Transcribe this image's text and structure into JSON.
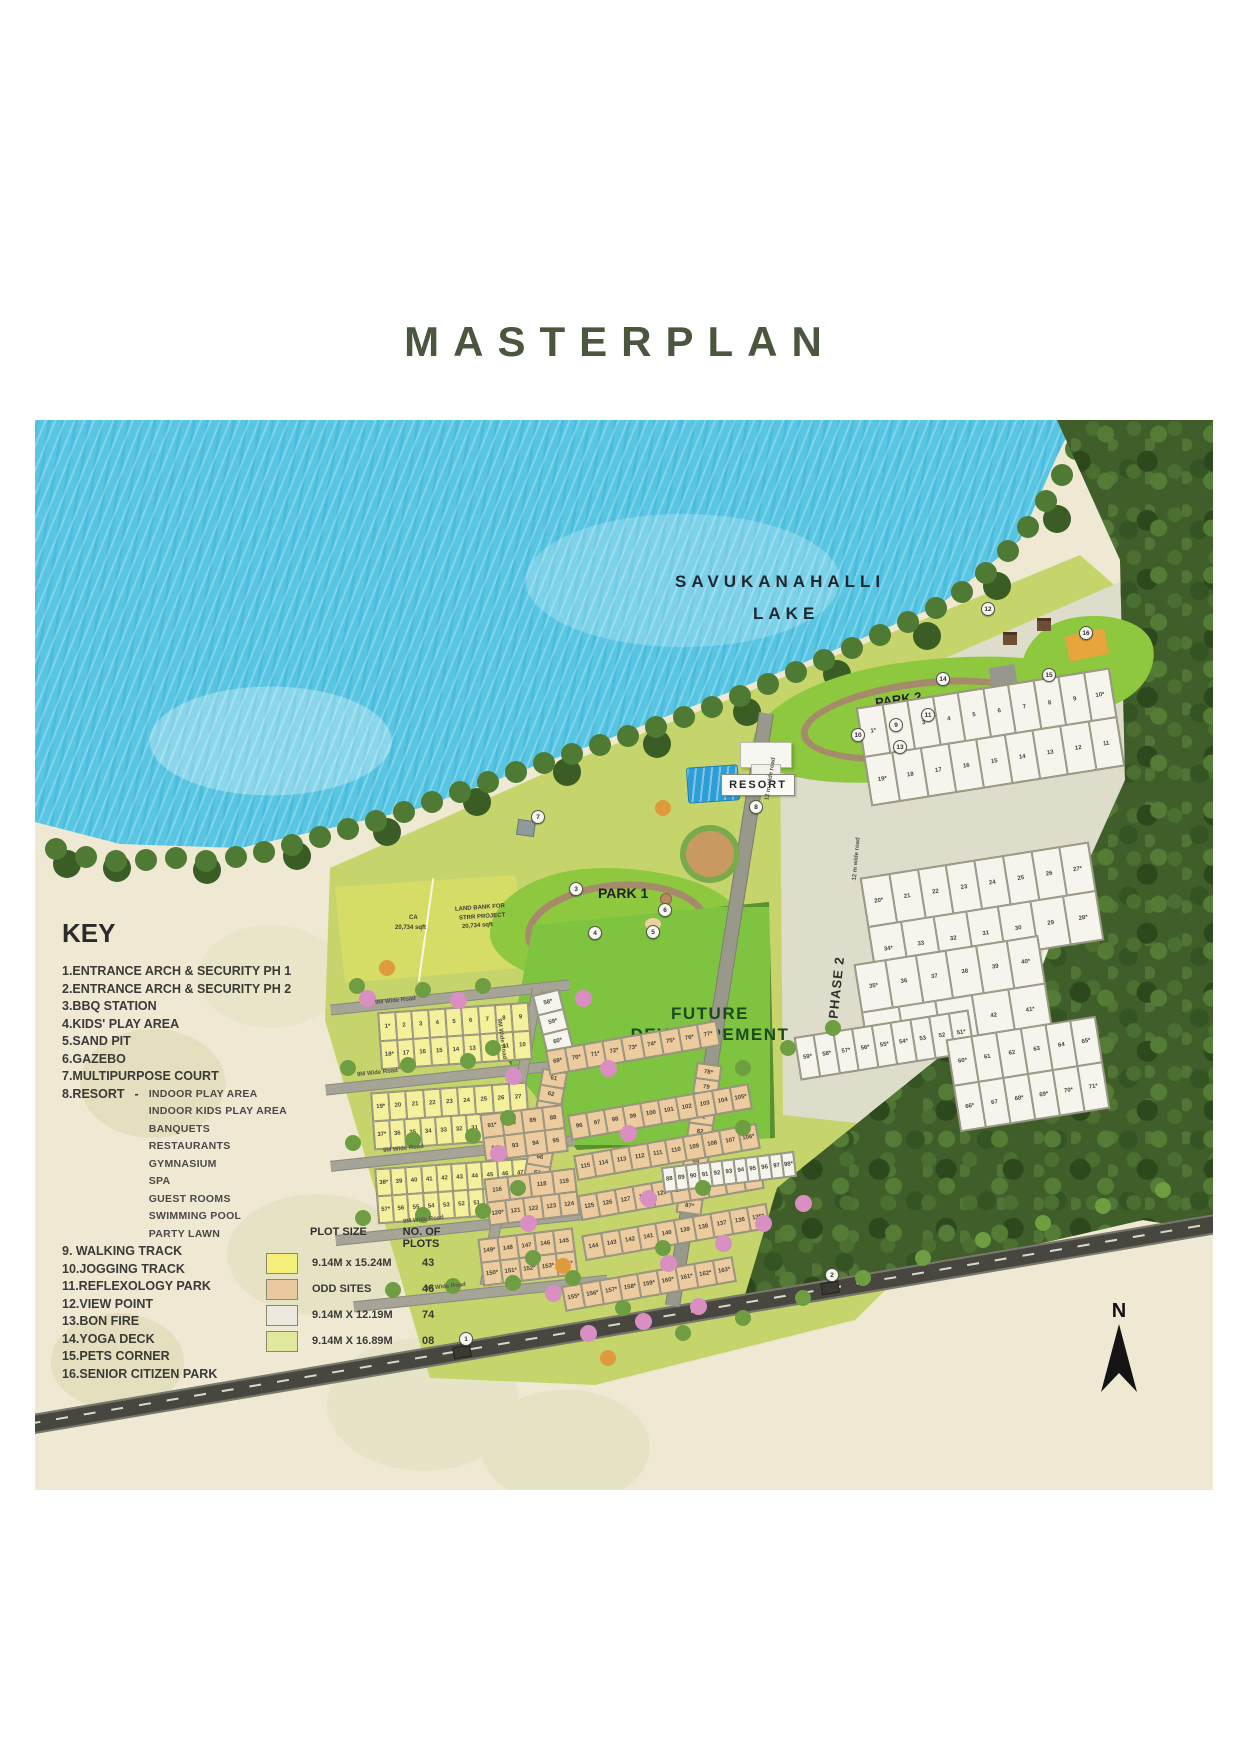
{
  "title": "MASTERPLAN",
  "map": {
    "labels": {
      "lake": [
        "SAVUKANAHALLI",
        "LAKE"
      ],
      "forest": "FOREST",
      "phase2": "PHASE 2",
      "park1": "PARK 1",
      "park2": "PARK 2",
      "resort": "RESORT",
      "future": [
        "FUTURE",
        "DEVELOPEMENT"
      ],
      "landbank1": [
        "LAND BANK FOR",
        "STRR PROJECT",
        "20,734 sqft"
      ],
      "ca1": [
        "CA",
        "20,734 sqft"
      ],
      "landbank2": [
        "LAND BANK FOR STRR PROJECT",
        "20,396 sqft"
      ],
      "ca2": [
        "CA",
        "20,692 sqft"
      ],
      "north": "N"
    },
    "road_labels": [
      {
        "t": "9M Wide Road",
        "x": 340,
        "y": 578,
        "r": -6
      },
      {
        "t": "9M Wide Road",
        "x": 322,
        "y": 650,
        "r": -6
      },
      {
        "t": "9M Wide Road",
        "x": 348,
        "y": 726,
        "r": -6
      },
      {
        "t": "9M Wide Road",
        "x": 368,
        "y": 797,
        "r": -6
      },
      {
        "t": "9M Wide Road",
        "x": 390,
        "y": 864,
        "r": -6
      },
      {
        "t": "9M Wide Road",
        "x": 446,
        "y": 616,
        "r": 82
      },
      {
        "t": "12 m wide road",
        "x": 800,
        "y": 436,
        "r": -85
      },
      {
        "t": "12 m wide road",
        "x": 714,
        "y": 356,
        "r": -81
      }
    ],
    "markers": [
      {
        "n": "1",
        "x": 424,
        "y": 912
      },
      {
        "n": "2",
        "x": 790,
        "y": 848
      },
      {
        "n": "3",
        "x": 534,
        "y": 462
      },
      {
        "n": "4",
        "x": 553,
        "y": 506
      },
      {
        "n": "5",
        "x": 611,
        "y": 505
      },
      {
        "n": "6",
        "x": 623,
        "y": 483
      },
      {
        "n": "7",
        "x": 496,
        "y": 390
      },
      {
        "n": "8",
        "x": 714,
        "y": 380
      },
      {
        "n": "9",
        "x": 854,
        "y": 298
      },
      {
        "n": "10",
        "x": 816,
        "y": 308
      },
      {
        "n": "11",
        "x": 886,
        "y": 288
      },
      {
        "n": "12",
        "x": 946,
        "y": 182
      },
      {
        "n": "13",
        "x": 858,
        "y": 320
      },
      {
        "n": "14",
        "x": 901,
        "y": 252
      },
      {
        "n": "15",
        "x": 1007,
        "y": 248
      },
      {
        "n": "16",
        "x": 1044,
        "y": 206
      }
    ],
    "plot_blocks": [
      {
        "x": 345,
        "y": 588,
        "w": 150,
        "h": 56,
        "r": -4,
        "c": "yellow",
        "rows": [
          [
            "1*",
            "2",
            "3",
            "4",
            "5",
            "6",
            "7",
            "8",
            "9"
          ],
          [
            "18*",
            "17",
            "16",
            "15",
            "14",
            "13",
            "12",
            "11",
            "10"
          ]
        ]
      },
      {
        "x": 505,
        "y": 572,
        "w": 26,
        "h": 60,
        "r": -14,
        "c": "white",
        "rows": [
          [
            "58*"
          ],
          [
            "59*"
          ],
          [
            "60*"
          ]
        ]
      },
      {
        "x": 338,
        "y": 668,
        "w": 155,
        "h": 56,
        "r": -4,
        "c": "yellow",
        "rows": [
          [
            "19*",
            "20",
            "21",
            "22",
            "23",
            "24",
            "25",
            "26",
            "27"
          ],
          [
            "37*",
            "36",
            "35",
            "34",
            "33",
            "32",
            "31",
            "30",
            "29",
            "28"
          ]
        ]
      },
      {
        "x": 342,
        "y": 744,
        "w": 152,
        "h": 54,
        "r": -4,
        "c": "yellow",
        "rows": [
          [
            "38*",
            "39",
            "40",
            "41",
            "42",
            "43",
            "44",
            "45",
            "46",
            "47"
          ],
          [
            "57*",
            "56",
            "55",
            "54",
            "53",
            "52",
            "51",
            "50",
            "49",
            "48"
          ]
        ]
      },
      {
        "x": 497,
        "y": 650,
        "w": 24,
        "h": 128,
        "r": 10,
        "c": "tan",
        "rows": [
          [
            "61"
          ],
          [
            "62"
          ],
          [
            "63"
          ],
          [
            "64"
          ],
          [
            "65"
          ],
          [
            "66"
          ],
          [
            "67"
          ],
          [
            "68"
          ]
        ]
      },
      {
        "x": 512,
        "y": 616,
        "w": 172,
        "h": 24,
        "r": -10,
        "c": "tan",
        "rows": [
          [
            "69*",
            "70*",
            "71*",
            "72*",
            "73*",
            "74*",
            "75*",
            "76*",
            "77*"
          ]
        ]
      },
      {
        "x": 652,
        "y": 644,
        "w": 24,
        "h": 150,
        "r": 8,
        "c": "tan",
        "rows": [
          [
            "78*"
          ],
          [
            "79"
          ],
          [
            "80"
          ],
          [
            "81"
          ],
          [
            "82"
          ],
          [
            "83"
          ],
          [
            "84"
          ],
          [
            "85"
          ],
          [
            "86"
          ],
          [
            "87*"
          ]
        ]
      },
      {
        "x": 448,
        "y": 690,
        "w": 82,
        "h": 46,
        "r": -7,
        "c": "tan",
        "rows": [
          [
            "91*",
            "90",
            "89",
            "88"
          ],
          [
            "92",
            "93",
            "94",
            "95"
          ]
        ]
      },
      {
        "x": 534,
        "y": 680,
        "w": 182,
        "h": 24,
        "r": -10,
        "c": "tan",
        "rows": [
          [
            "96",
            "97",
            "98",
            "99",
            "100",
            "101",
            "102",
            "103",
            "104",
            "105*"
          ]
        ]
      },
      {
        "x": 540,
        "y": 720,
        "w": 184,
        "h": 24,
        "r": -10,
        "c": "tan",
        "rows": [
          [
            "115",
            "114",
            "113",
            "112",
            "111",
            "110",
            "109",
            "108",
            "107",
            "106*"
          ]
        ]
      },
      {
        "x": 452,
        "y": 754,
        "w": 90,
        "h": 46,
        "r": -7,
        "c": "tan",
        "rows": [
          [
            "116",
            "117",
            "118",
            "119"
          ],
          [
            "120*",
            "121",
            "122",
            "123",
            "124"
          ]
        ]
      },
      {
        "x": 544,
        "y": 760,
        "w": 184,
        "h": 24,
        "r": -10,
        "c": "tan",
        "rows": [
          [
            "125",
            "126",
            "127",
            "128",
            "129",
            "130",
            "131",
            "132",
            "133",
            "134*"
          ]
        ]
      },
      {
        "x": 446,
        "y": 814,
        "w": 94,
        "h": 46,
        "r": -7,
        "c": "tan",
        "rows": [
          [
            "149*",
            "148",
            "147",
            "146",
            "145"
          ],
          [
            "150*",
            "151*",
            "152*",
            "153*",
            "154*"
          ]
        ]
      },
      {
        "x": 548,
        "y": 800,
        "w": 186,
        "h": 24,
        "r": -10,
        "c": "tan",
        "rows": [
          [
            "144",
            "143",
            "142",
            "141",
            "140",
            "139",
            "138",
            "137",
            "136",
            "135*"
          ]
        ]
      },
      {
        "x": 528,
        "y": 852,
        "w": 172,
        "h": 24,
        "r": -10,
        "c": "tan",
        "rows": [
          [
            "155*",
            "156*",
            "157*",
            "158*",
            "159*",
            "160*",
            "161*",
            "162*",
            "163*"
          ]
        ]
      },
      {
        "x": 828,
        "y": 268,
        "w": 255,
        "h": 98,
        "r": -9,
        "c": "white",
        "rows": [
          [
            "1*",
            "2",
            "3",
            "4",
            "5",
            "6",
            "7",
            "8",
            "9",
            "10*"
          ],
          [
            "19*",
            "18",
            "17",
            "16",
            "15",
            "14",
            "13",
            "12",
            "11"
          ]
        ]
      },
      {
        "x": 832,
        "y": 440,
        "w": 230,
        "h": 98,
        "r": -9,
        "c": "white",
        "rows": [
          [
            "20*",
            "21",
            "22",
            "23",
            "24",
            "25",
            "26",
            "27*"
          ],
          [
            "34*",
            "33",
            "32",
            "31",
            "30",
            "29",
            "28*"
          ]
        ]
      },
      {
        "x": 826,
        "y": 530,
        "w": 185,
        "h": 96,
        "r": -9,
        "c": "white",
        "rows": [
          [
            "35*",
            "36",
            "37",
            "38",
            "39",
            "40*"
          ],
          [
            "45*",
            "44",
            "43",
            "42",
            "41*"
          ]
        ]
      },
      {
        "x": 762,
        "y": 604,
        "w": 175,
        "h": 42,
        "r": -9,
        "c": "white",
        "rows": [
          [
            "59*",
            "58*",
            "57*",
            "56*",
            "55*",
            "54*",
            "53",
            "52",
            "51*"
          ]
        ]
      },
      {
        "x": 918,
        "y": 608,
        "w": 150,
        "h": 92,
        "r": -9,
        "c": "white",
        "rows": [
          [
            "60*",
            "61",
            "62",
            "63",
            "64",
            "65*"
          ],
          [
            "66*",
            "67",
            "68*",
            "69*",
            "70*",
            "71*"
          ]
        ]
      },
      {
        "x": 628,
        "y": 740,
        "w": 132,
        "h": 24,
        "r": -7,
        "c": "white",
        "rows": [
          [
            "88",
            "89",
            "90",
            "91",
            "92",
            "93",
            "94",
            "95",
            "96",
            "97",
            "98*"
          ]
        ]
      }
    ]
  },
  "key": {
    "heading": "KEY",
    "items": [
      "1.ENTRANCE ARCH & SECURITY PH 1",
      "2.ENTRANCE ARCH & SECURITY PH 2",
      "3.BBQ STATION",
      "4.KIDS' PLAY AREA",
      "5.SAND PIT",
      "6.GAZEBO",
      "7.MULTIPURPOSE COURT"
    ],
    "resort_label": "8.RESORT",
    "resort_dash": "-",
    "resort_items": [
      "INDOOR PLAY AREA",
      "INDOOR KIDS PLAY AREA",
      "BANQUETS",
      "RESTAURANTS",
      "GYMNASIUM",
      "SPA",
      "GUEST ROOMS",
      "SWIMMING POOL",
      "PARTY LAWN"
    ],
    "items2": [
      "9. WALKING TRACK",
      "10.JOGGING TRACK",
      "11.REFLEXOLOGY PARK",
      "12.VIEW POINT",
      "13.BON FIRE",
      "14.YOGA DECK",
      "15.PETS CORNER",
      "16.SENIOR CITIZEN PARK"
    ]
  },
  "table": {
    "headers": [
      "PLOT SIZE",
      "NO. OF PLOTS"
    ],
    "rows": [
      {
        "color": "#f5f07c",
        "size": "9.14M x 15.24M",
        "count": "43"
      },
      {
        "color": "#eac8a0",
        "size": "ODD SITES",
        "count": "46"
      },
      {
        "color": "#eceadf",
        "size": "9.14M X 12.19M",
        "count": "74"
      },
      {
        "color": "#dfe89c",
        "size": "9.14M X 16.89M",
        "count": "08"
      }
    ]
  }
}
